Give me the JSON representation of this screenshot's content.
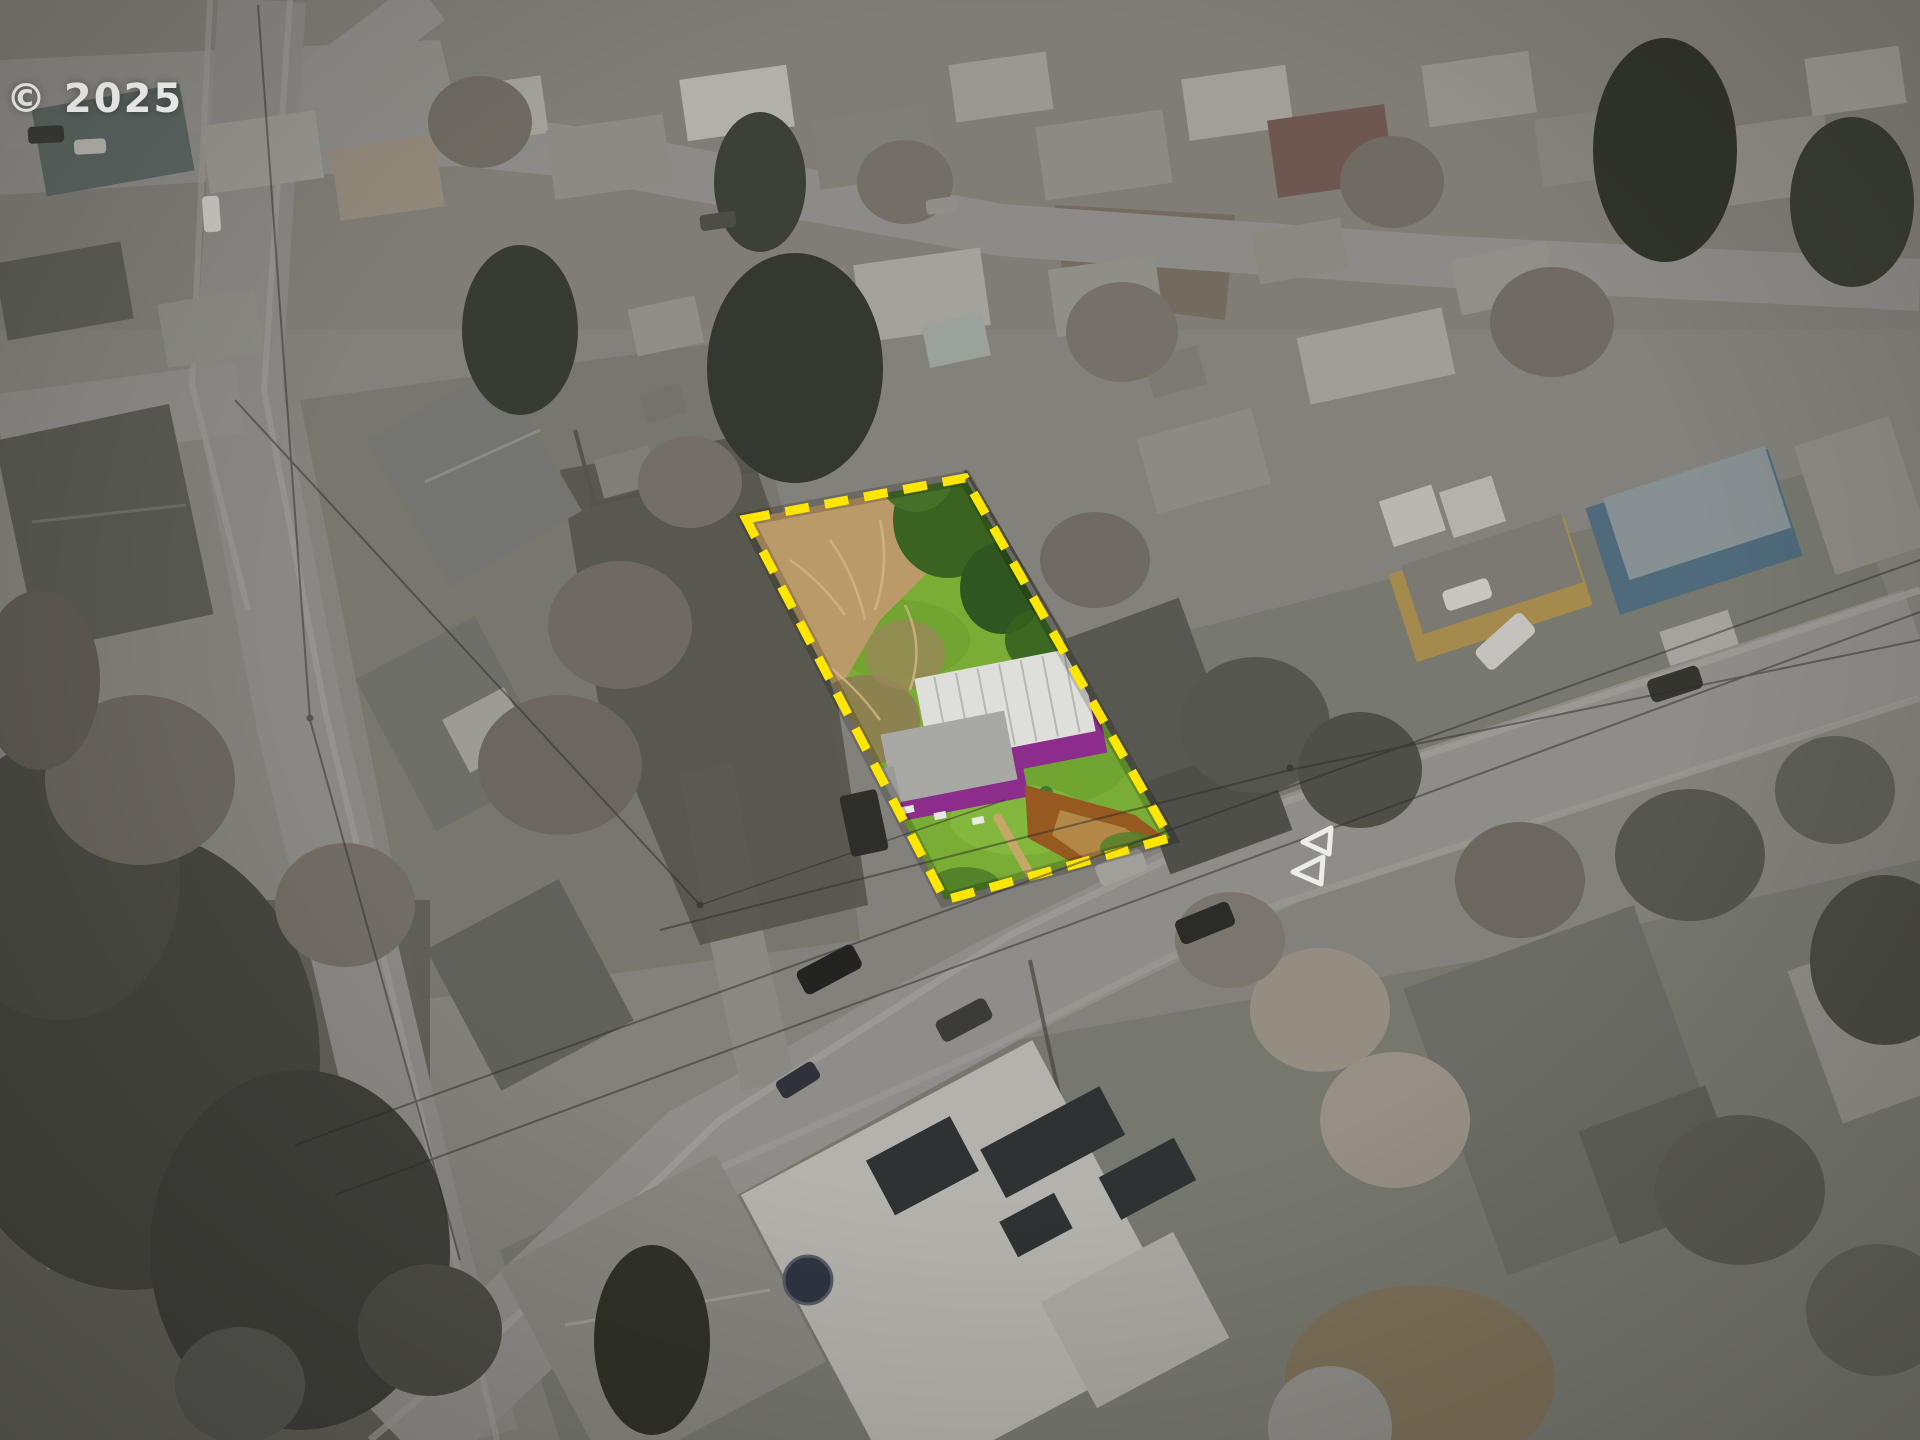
{
  "watermark": {
    "text": "© 2025"
  },
  "highlight": {
    "boundary_color": "#FFE600"
  },
  "colors": {
    "house_purple": "#8C2D8C",
    "metal_roof_white": "#DEDEDA",
    "lot_grass_green": "#7AAD35",
    "dry_brush_tan": "#BB9A6A",
    "road_marking_white": "#F2F2EE"
  }
}
